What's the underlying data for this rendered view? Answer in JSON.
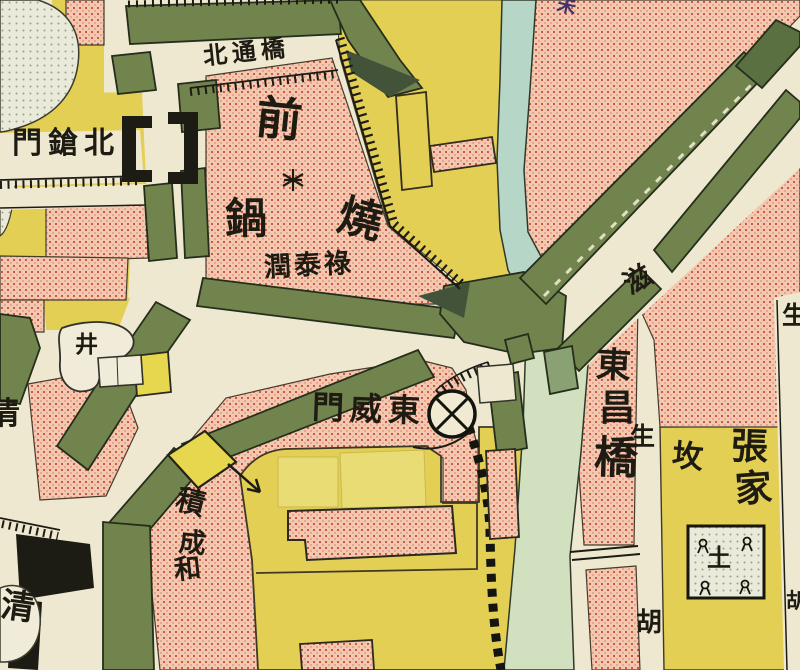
{
  "map": {
    "type": "historical-city-map-scan",
    "labels": {
      "north_bridge": "北通橋",
      "north_gun_gate": "門鎗北",
      "qian": "前",
      "guo": "鍋",
      "shao": "燒",
      "shop_runtailu": "潤泰祿",
      "east_wei_gate": "門威東",
      "bridge_dong": "東",
      "bridge_chang": "昌",
      "bridge_qiao": "橋",
      "street_zi": "滋",
      "street_sheng": "生",
      "street_hu": "胡",
      "grave_fen": "坆",
      "zhang": "張",
      "jia": "家",
      "shop_ji": "積",
      "shop_cheng": "成",
      "shop_he": "和",
      "qing_west": "清",
      "qing_southwest": "清",
      "well": "井",
      "grave_soil": "土",
      "edge_top_char": "未",
      "edge_east_sheng": "生",
      "edge_east_hu": "胡"
    },
    "symbols": {
      "gate_circle": "circled-X city-gate symbol",
      "asterisk": "※",
      "well_mark": "井",
      "wall_dashes": "crenellated wall dashed band",
      "grave_plot": "walled grave plot with corner markers"
    },
    "colors": {
      "paper": "#efe8d0",
      "yellow_block": "#e4cf55",
      "pink_block": "#f2c8b0",
      "stipple_red": "#c23b25",
      "green_band": "#71844e",
      "dark_green": "#42533a",
      "river": "#b6d6c7",
      "channel": "#d1e1c0",
      "pale_area": "#eaeadb",
      "ink": "#1c1c15"
    }
  }
}
